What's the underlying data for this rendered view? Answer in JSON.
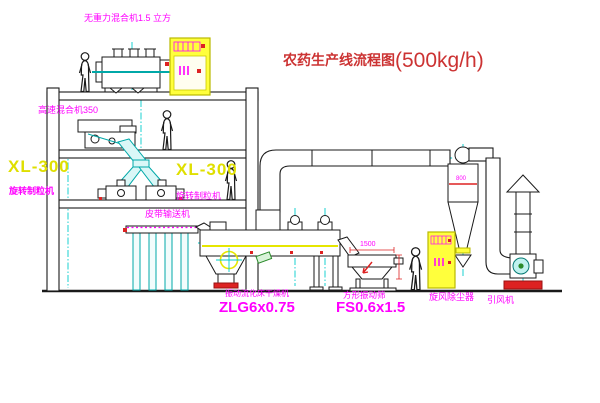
{
  "diagram": {
    "title": {
      "name": "农药生产线流程图",
      "capacity": "(500kg/h)"
    },
    "equipment_labels": {
      "gravity_mixer": "无重力混合机1.5 立方",
      "high_speed_mixer": "高速混合机350",
      "left_granulator_model": "XL-300",
      "left_granulator_name": "旋转制粒机",
      "mid_granulator_model": "XL-300",
      "mid_granulator_name": "旋转制粒机",
      "belt_conveyor": "皮带输送机",
      "fluid_bed_dryer_name": "振动流化床干燥机",
      "fluid_bed_dryer_model": "ZLG6x0.75",
      "vibrating_screen_name": "方形振动筛",
      "vibrating_screen_model": "FS0.6x1.5",
      "cyclone_dust_collector": "旋风除尘器",
      "induced_draft_fan": "引风机"
    },
    "dimensions": {
      "screen_length": "1500",
      "cyclone_width": "800"
    },
    "colors": {
      "title_red": "#cc3333",
      "label_magenta": "#ff00ff",
      "model_yellow": "#dfdf00",
      "pipe_cyan": "#00a8a8",
      "centerline_cyan": "#00cccc",
      "accent_red": "#dd2222",
      "cabinet_yellow": "#ffff3c",
      "machine_line": "#1a1a1a"
    }
  }
}
